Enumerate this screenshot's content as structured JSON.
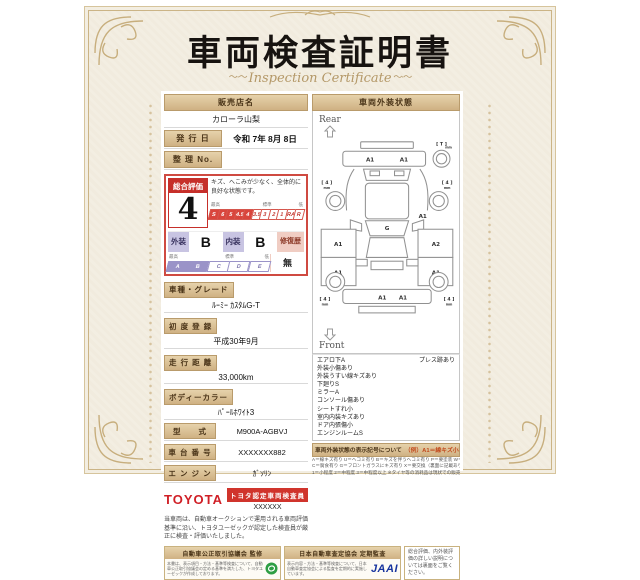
{
  "title": "車両検査証明書",
  "subtitle": "Inspection Certificate",
  "dealer": {
    "label": "販売店名",
    "value": "カローラ山梨"
  },
  "issue": {
    "label": "発 行 日",
    "value": "令和 7年 8月 8日"
  },
  "ref_no": {
    "label": "整 理 No.",
    "value": ""
  },
  "evaluation": {
    "overall_label": "総合評価",
    "overall_value": "4",
    "comment": "キズ、へこみが少なく、全体的に良好な状態です。",
    "scale_labels": {
      "high": "最高",
      "mid": "標準",
      "low": "低"
    },
    "overall_scale": [
      "S",
      "6",
      "5",
      "4.5",
      "4",
      "3.5",
      "3",
      "2",
      "1",
      "RA",
      "R"
    ],
    "overall_selected": "4",
    "exterior_label": "外装",
    "exterior_value": "B",
    "interior_label": "内装",
    "interior_value": "B",
    "repair_label": "修復歴",
    "repair_value": "無",
    "grade_scale": [
      "A",
      "B",
      "C",
      "D",
      "E"
    ],
    "grade_selected": "B"
  },
  "specs": [
    {
      "label": "車種・グレード",
      "value": "ﾙｰﾐｰ ｶｽﾀﾑG-T"
    },
    {
      "label": "初 度 登 録",
      "value": "平成30年9月"
    },
    {
      "label": "走 行 距 離",
      "value": "33,000km"
    },
    {
      "label": "ボディーカラー",
      "value": "ﾊﾟｰﾙﾎﾜｲﾄ3"
    },
    {
      "label": "型　　式",
      "value": "M900A-AGBVJ"
    },
    {
      "label": "車 台 番 号",
      "value": "XXXXXXX882"
    },
    {
      "label": "エ ン ジ ン",
      "value": "ｶﾞｿﾘﾝ"
    }
  ],
  "inspector": {
    "brand": "TOYOTA",
    "badge": "トヨタ認定車両検査員",
    "inspector_id": "XXXXXX"
  },
  "disclaimer": "当車両は、自動車オークションで運用される車両評価基準に沿い、トヨタユーゼックが認定した検査員が厳正に検査・評価いたしました。",
  "exterior": {
    "header": "車両外装状態",
    "rear_label": "Rear",
    "front_label": "Front",
    "marks": {
      "rear_bumper": [
        "A1",
        "A1"
      ],
      "right_quarter": "A1",
      "left_doors": [
        "A1",
        "A1"
      ],
      "right_doors": [
        "A2",
        "A1"
      ],
      "windshield": "G",
      "front_bumper": [
        "A1",
        "A1"
      ]
    },
    "tires": {
      "spare": "[ T ]",
      "rear_left": "[ 4 ]",
      "rear_right": "[ 4 ]",
      "front_left": "[ 4 ]",
      "front_right": "[ 4 ]",
      "unit": "mm"
    },
    "notes": [
      "エアロ下A",
      "外装小傷あり",
      "外装うすい線キズあり",
      "下廻りS",
      "ミラーA",
      "コンソール傷あり",
      "シートすれ小",
      "室内内装キズあり",
      "ドア内張傷小",
      "エンジンルームS"
    ],
    "notes_right": [
      "プレス跡あり"
    ],
    "legend": {
      "header": "車両外装状態の表示記号について",
      "example": "（例）A1＝線キズ小程度有り",
      "lines": [
        "A＝線キズ有り U＝ヘコミ有り B＝キズを伴うヘコミ有り P＝要塗装 W＝補修跡有り S＝サビ有り",
        "C＝腐食有り G＝フロントガラスにキズ有り X＝要交換（裏面に記載あり） XX＝交換跡有り",
        "1＝小程度 2＝中程度 3＝中程度以上 ※タイヤ等の消耗品は現状での販売となります。"
      ]
    }
  },
  "footer": {
    "fair_trade": {
      "title": "自動車公正取引協議会 監修",
      "text": "本書は、表示項目・方法・基準等検査について、自動車公正取引協議会の定める基準を満たした、トヨタユーゼックが作成しております。"
    },
    "jaai": {
      "title": "日本自動車査定協会 定期監査",
      "text": "表示内容・方法・基準等検査について、日本自動車査定協会による監査を定期的に実施しています。",
      "logo": "JAAI"
    },
    "note": "総合評価、内外装評価の詳しい説明については裏面をご覧ください。"
  },
  "colors": {
    "accent_red": "#c62f2a",
    "gold": "#cfb183",
    "lavender": "#9a93c8",
    "toyota_red": "#d01f26",
    "jaai_blue": "#17349e",
    "eco_green": "#2e9e44"
  }
}
